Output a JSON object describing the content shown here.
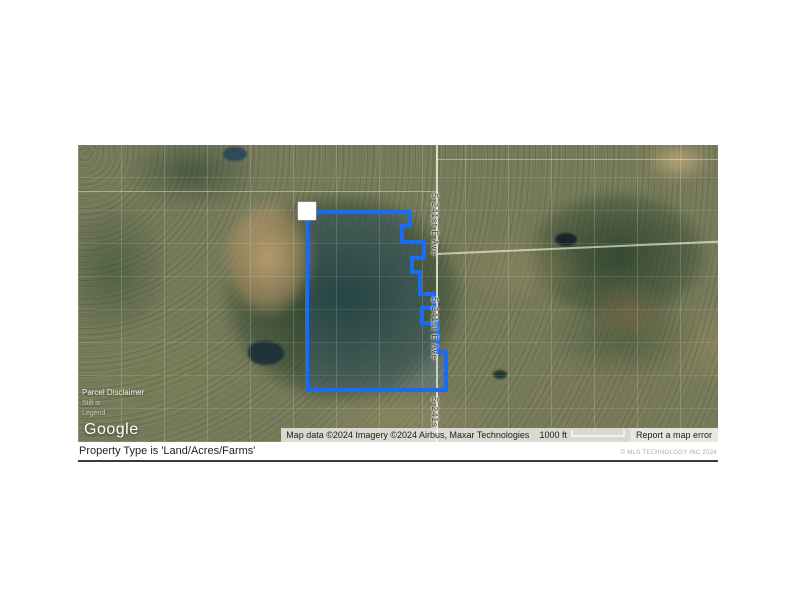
{
  "map": {
    "road_label": "S 241st E Ave",
    "overlay": {
      "line1": "Parcel Disclaimer",
      "line2": "Still is",
      "line3": "Legend"
    },
    "google_logo": "Google",
    "attribution": {
      "text": "Map data ©2024  Imagery ©2024 Airbus, Maxar Technologies",
      "scale_label": "1000 ft",
      "report_error": "Report a map error"
    },
    "colors": {
      "boundary": "#1b6cf0",
      "boundary_fill": "rgba(27,108,240,0.12)"
    }
  },
  "footer": {
    "filter_text": "Property Type is 'Land/Acres/Farms'",
    "copyright": "© MLS TECHNOLOGY INC 2024"
  }
}
